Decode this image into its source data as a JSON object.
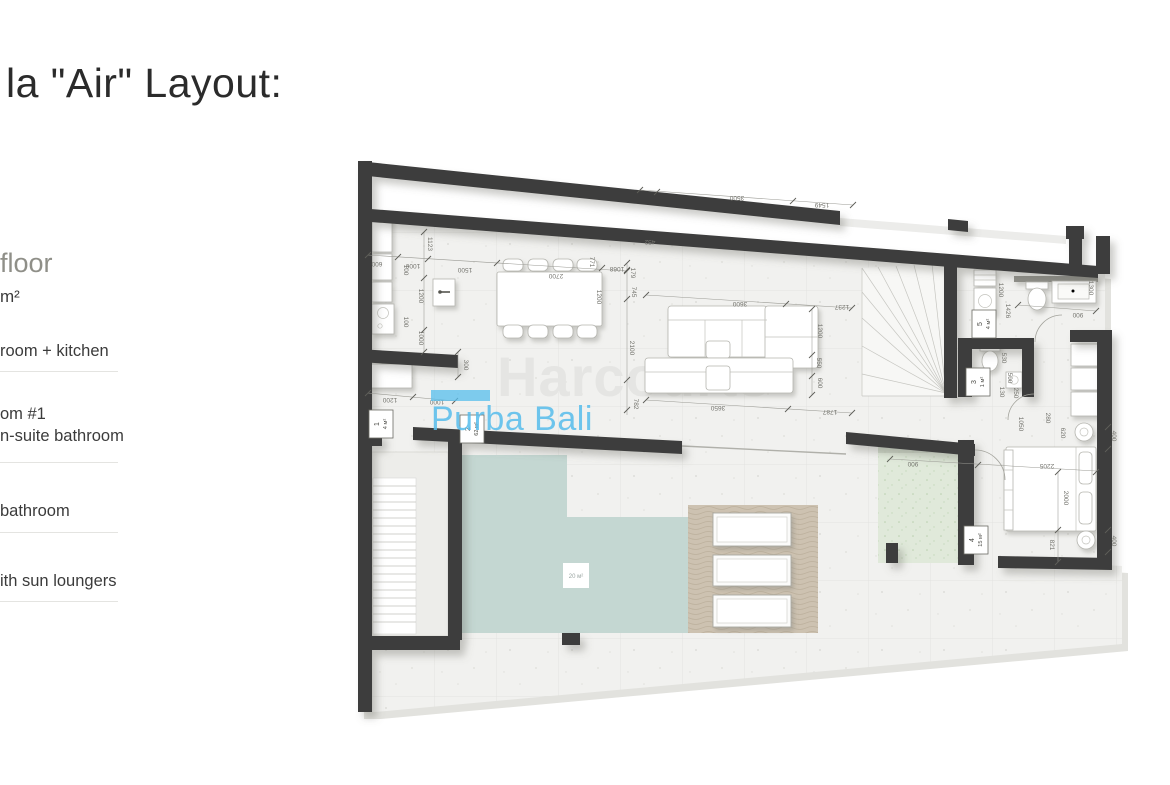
{
  "page": {
    "title": "la \"Air\" Layout:"
  },
  "sidebar": {
    "heading": "floor",
    "area_unit": "m²",
    "items": [
      {
        "line1": "room + kitchen",
        "line2": ""
      },
      {
        "line1": "om #1",
        "line2": "n-suite bathroom"
      },
      {
        "line1": "bathroom",
        "line2": ""
      },
      {
        "line1": "ith sun loungers",
        "line2": ""
      }
    ]
  },
  "plan": {
    "watermark": {
      "brand": "Harcourts",
      "sub": "Purba Bali"
    },
    "pool_label": "20 м²",
    "room_labels": [
      {
        "num": "1",
        "area": "4 м²",
        "x": 381,
        "y": 424
      },
      {
        "num": "2",
        "area": "62 м²",
        "x": 472,
        "y": 429
      },
      {
        "num": "5",
        "area": "4 м²",
        "x": 984,
        "y": 324
      },
      {
        "num": "3",
        "area": "1 м²",
        "x": 978,
        "y": 382
      },
      {
        "num": "4",
        "area": "15 м²",
        "x": 976,
        "y": 540
      }
    ],
    "dims": [
      {
        "t": "600",
        "x": 377,
        "y": 262,
        "r": 180
      },
      {
        "t": "1000",
        "x": 413,
        "y": 264,
        "r": 180
      },
      {
        "t": "1500",
        "x": 465,
        "y": 268,
        "r": 180
      },
      {
        "t": "2700",
        "x": 556,
        "y": 274,
        "r": 180
      },
      {
        "t": "771",
        "x": 590,
        "y": 262,
        "r": 90
      },
      {
        "t": "1068",
        "x": 617,
        "y": 267,
        "r": 180
      },
      {
        "t": "1123",
        "x": 428,
        "y": 244,
        "r": 90
      },
      {
        "t": "100",
        "x": 404,
        "y": 270,
        "r": 90
      },
      {
        "t": "100",
        "x": 404,
        "y": 322,
        "r": 90
      },
      {
        "t": "1200",
        "x": 419,
        "y": 296,
        "r": 90
      },
      {
        "t": "1000",
        "x": 419,
        "y": 338,
        "r": 90
      },
      {
        "t": "1200",
        "x": 597,
        "y": 297,
        "r": 90
      },
      {
        "t": "300",
        "x": 464,
        "y": 365,
        "r": 90
      },
      {
        "t": "1200",
        "x": 390,
        "y": 398,
        "r": 180
      },
      {
        "t": "1000",
        "x": 437,
        "y": 400,
        "r": 180
      },
      {
        "t": "452",
        "x": 650,
        "y": 240,
        "r": 180
      },
      {
        "t": "3500",
        "x": 737,
        "y": 196,
        "r": 180
      },
      {
        "t": "1549",
        "x": 822,
        "y": 203,
        "r": 180
      },
      {
        "t": "179",
        "x": 631,
        "y": 273,
        "r": 90
      },
      {
        "t": "745",
        "x": 632,
        "y": 292,
        "r": 90
      },
      {
        "t": "2100",
        "x": 630,
        "y": 348,
        "r": 90
      },
      {
        "t": "782",
        "x": 634,
        "y": 404,
        "r": 90
      },
      {
        "t": "3600",
        "x": 740,
        "y": 302,
        "r": 180
      },
      {
        "t": "1237",
        "x": 842,
        "y": 305,
        "r": 180
      },
      {
        "t": "1200",
        "x": 818,
        "y": 331,
        "r": 90
      },
      {
        "t": "550",
        "x": 817,
        "y": 363,
        "r": 90
      },
      {
        "t": "600",
        "x": 818,
        "y": 383,
        "r": 90
      },
      {
        "t": "3650",
        "x": 718,
        "y": 406,
        "r": 180
      },
      {
        "t": "1787",
        "x": 830,
        "y": 410,
        "r": 180
      },
      {
        "t": "1200",
        "x": 999,
        "y": 290,
        "r": 90
      },
      {
        "t": "1426",
        "x": 1006,
        "y": 311,
        "r": 90
      },
      {
        "t": "1300",
        "x": 1089,
        "y": 288,
        "r": 90
      },
      {
        "t": "900",
        "x": 1078,
        "y": 313,
        "r": 180
      },
      {
        "t": "530",
        "x": 1002,
        "y": 358,
        "r": 90
      },
      {
        "t": "500",
        "x": 1008,
        "y": 378,
        "r": 90
      },
      {
        "t": "130",
        "x": 1000,
        "y": 392,
        "r": 90
      },
      {
        "t": "250",
        "x": 1014,
        "y": 393,
        "r": 90
      },
      {
        "t": "1050",
        "x": 1019,
        "y": 424,
        "r": 90
      },
      {
        "t": "280",
        "x": 1046,
        "y": 418,
        "r": 90
      },
      {
        "t": "620",
        "x": 1061,
        "y": 433,
        "r": 90
      },
      {
        "t": "400",
        "x": 1112,
        "y": 436,
        "r": 90
      },
      {
        "t": "900",
        "x": 913,
        "y": 462,
        "r": 180
      },
      {
        "t": "2205",
        "x": 1047,
        "y": 464,
        "r": 180
      },
      {
        "t": "2000",
        "x": 1064,
        "y": 498,
        "r": 90
      },
      {
        "t": "821",
        "x": 1050,
        "y": 545,
        "r": 90
      },
      {
        "t": "400",
        "x": 1112,
        "y": 541,
        "r": 90
      }
    ],
    "colors": {
      "wall": "#3d3d3d",
      "pool": "#c4d7d2",
      "deck": "#cdc2b1",
      "garden": "#e0e9da",
      "accent_blue": "#56bdec",
      "watermark_gray": "#e5e5e3"
    }
  }
}
